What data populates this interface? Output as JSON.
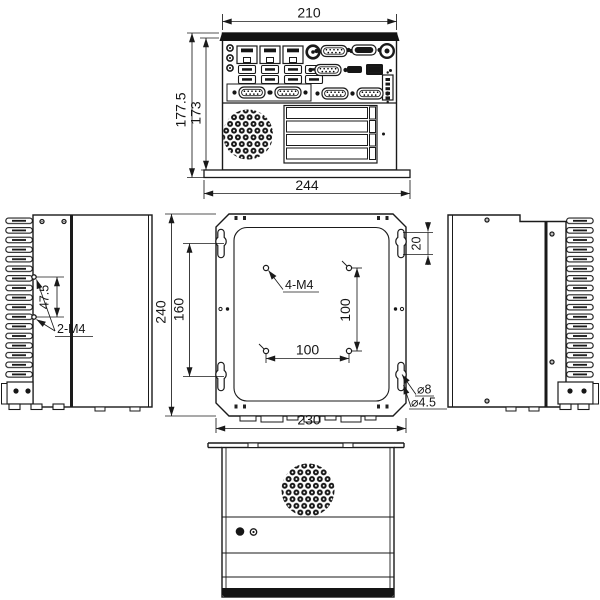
{
  "front_view": {
    "width_top": "210",
    "height_overall": "177.5",
    "height_body": "173",
    "width_bottom": "244"
  },
  "left_side_view": {
    "hole_pitch": "47.5",
    "thread_label": "2-M4"
  },
  "mounting_plate_view": {
    "height": "240",
    "keyhole_pitch": "160",
    "thread_label": "4-M4",
    "vesa_pitch_vertical": "100",
    "vesa_pitch_horizontal": "100",
    "keyhole_slot_length": "20",
    "keyhole_diameter": "⌀8",
    "keyhole_slot_width": "⌀4.5",
    "width": "230"
  }
}
